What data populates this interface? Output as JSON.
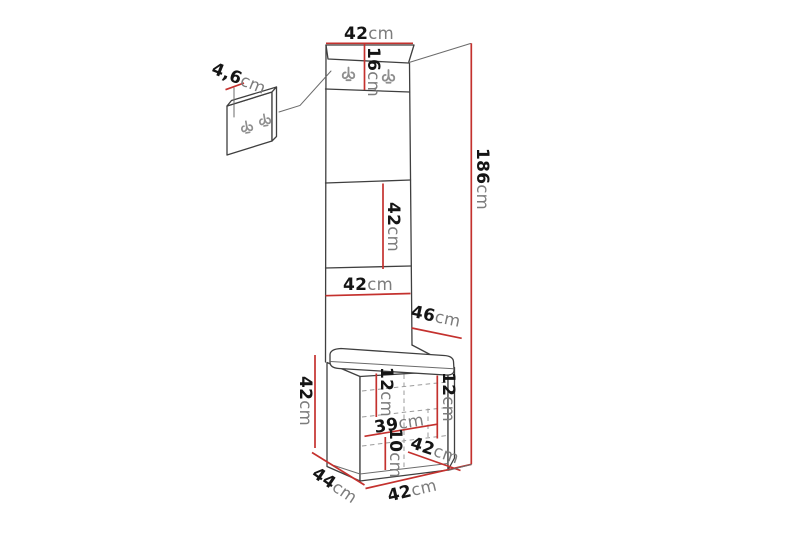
{
  "diagram": {
    "type": "furniture-dimension-diagram",
    "subject": "hallway coat-hook wall panel column with cushioned storage bench",
    "unit_suffix": "cm",
    "colors": {
      "dimension_line": "#c4312e",
      "outline": "#3f3f3f",
      "dashed": "#9b9b9b",
      "hook": "#8f8f8f",
      "number_text": "#151515",
      "unit_text": "#7c7c7c",
      "background": "#ffffff"
    },
    "icons": {
      "coat_hook": "double-prong coat hook"
    },
    "dimensions": {
      "panel_width_top": {
        "value": "42",
        "unit": "cm"
      },
      "hook_panel_height": {
        "value": "16",
        "unit": "cm"
      },
      "panel_thickness": {
        "value": "4,6",
        "unit": "cm"
      },
      "total_height": {
        "value": "186",
        "unit": "cm"
      },
      "mid_panel_height": {
        "value": "42",
        "unit": "cm"
      },
      "mid_panel_width": {
        "value": "42",
        "unit": "cm"
      },
      "bench_top_depth": {
        "value": "46",
        "unit": "cm"
      },
      "bench_height": {
        "value": "42",
        "unit": "cm"
      },
      "drawer_upper_left_height": {
        "value": "12",
        "unit": "cm"
      },
      "drawer_upper_right_height": {
        "value": "12",
        "unit": "cm"
      },
      "drawer_inner_width": {
        "value": "39",
        "unit": "cm"
      },
      "drawer_lower_height": {
        "value": "10",
        "unit": "cm"
      },
      "drawer_front_width": {
        "value": "42",
        "unit": "cm"
      },
      "bench_bottom_depth": {
        "value": "44",
        "unit": "cm"
      },
      "bench_bottom_width": {
        "value": "42",
        "unit": "cm"
      }
    }
  }
}
